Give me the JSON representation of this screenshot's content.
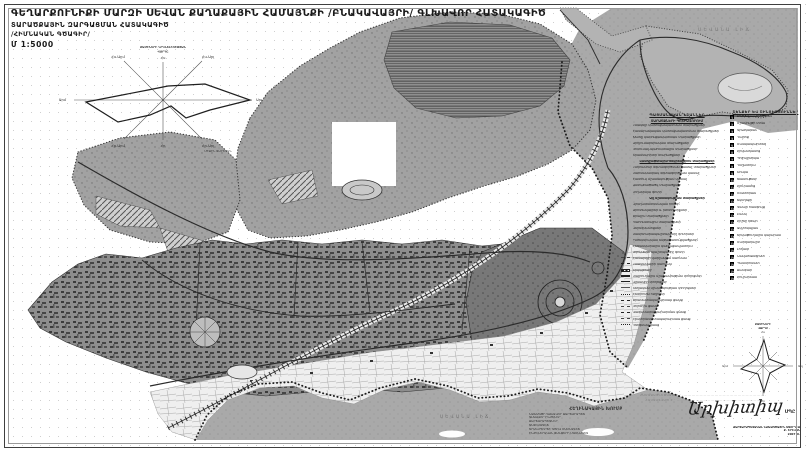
{
  "title": {
    "line1": "ԳԵՂԱՐՔՈՒՆԻՔԻ ՄԱՐԶԻ ՍԵՎԱՆ ՔԱՂԱՔԱՅԻՆ ՀԱՄԱՅՆՔԻ /ԲՆԱԿԱՎԱՅՐԻ/ ԳԼԽԱՎՈՐ ՀԱՏԱԿԱԳԻԾ",
    "line2": "ՏԱՐԱԾՔԱՅԻՆ ԶԱՐԳԱՑՄԱՆ ՀԱՏԱԿԱԳԻԾ",
    "line3": "/ՀԻՄՆԱԿԱՆ ԳԾԱԳԻՐ/",
    "scale": "Մ 1:5000"
  },
  "map_labels": {
    "lake_main": "ՍԵՎԱՆԱ ԼԻՃ",
    "lake_bay": "ՍԵՎԱՆԱ ԼԻՃ"
  },
  "wind_rose_top": {
    "title_line1": "ՔԱՄԻՆԵՐԻ ԿՐԿՆԵԼԻՈՒԹՅԱՆ",
    "title_line2": "ՎԱՐԴԸ",
    "note": "ՄԻՋԻՆ ՏԱՐԵԿԱՆ",
    "dir_n": "Հս",
    "dir_ne": "Հս-Արլ",
    "dir_e": "Արլ",
    "dir_se": "Հր-Արլ",
    "dir_s": "Հր",
    "dir_sw": "Հր-Արմ",
    "dir_w": "Արմ",
    "dir_nw": "Հս-Արմ"
  },
  "wind_rose_bottom": {
    "title": "ՔԱՄԻՆԵՐԻ",
    "title2": "ՎԱՐԴԸ",
    "dir_n": "Հս",
    "dir_s": "Հր",
    "dir_w": "Արմ",
    "dir_e": "Արլ"
  },
  "legend_zones": {
    "header": "ՊԱՅՄԱՆԱԿԱՆ ՆՇԱՆՆԵՐ",
    "subheader": "ՏԱՐԱԾՔՆԵՐԻ ԳՈՏԻԱՎՈՐՈՒՄ",
    "items": [
      {
        "type": "swatch",
        "swatch": "sw-urban",
        "label": "Բնակելի կառուցապատման տարածքներ"
      },
      {
        "type": "swatch",
        "swatch": "sw-cross",
        "label": "Հասարակական կառուցապատման տարածքներ"
      },
      {
        "type": "swatch",
        "swatch": "sw-gray60",
        "label": "Խառը կառուցապատման տարածքներ"
      },
      {
        "type": "swatch",
        "swatch": "sw-gray45",
        "label": "Արդյունաբերական տարածքներ"
      },
      {
        "type": "swatch",
        "swatch": "sw-stripe",
        "label": "Կոմունալ-պահեստային տարածքներ"
      },
      {
        "type": "swatch",
        "swatch": "sw-gray30",
        "label": "Տրանսպորտի տարածքներ"
      },
      {
        "type": "subheader",
        "label": "Լանդշաֆտային-ռեկրեացիոն տարածքներ"
      },
      {
        "type": "swatch",
        "swatch": "sw-dots-dark",
        "label": "Ընդհանուր օգտագործման կանաչ տարածքներ"
      },
      {
        "type": "swatch",
        "swatch": "sw-gray70",
        "label": "Սահմանափակ օգտագործման կանաչ"
      },
      {
        "type": "swatch",
        "swatch": "sw-dots",
        "label": "Հատուկ նշանակության կանաչ"
      },
      {
        "type": "swatch",
        "swatch": "sw-gray80",
        "label": "Անտառածածկ տարածքներ"
      },
      {
        "type": "swatch",
        "swatch": "sw-light-dots",
        "label": "Լողափնյա գոտի"
      },
      {
        "type": "subheader",
        "label": "Այլ նշանակության տարածքներ"
      },
      {
        "type": "swatch",
        "swatch": "sw-white",
        "label": "Գյուղատնտեսական հողեր"
      },
      {
        "type": "swatch",
        "swatch": "sw-dots",
        "label": "Արոտավայրեր և խոտհարքներ"
      },
      {
        "type": "swatch",
        "swatch": "sw-water",
        "label": "Ջրային տարածքներ"
      },
      {
        "type": "swatch",
        "swatch": "sw-light",
        "label": "Պահուստային տարածքներ"
      },
      {
        "type": "swatch",
        "swatch": "sw-cross",
        "label": "Գերեզմանոցներ"
      },
      {
        "type": "swatch",
        "swatch": "sw-hatch",
        "label": "Սանիտարապաշտպանիչ գոտիներ"
      },
      {
        "type": "swatch",
        "swatch": "sw-gray50",
        "label": "Ինժեներական ենթակառուցվածքներ"
      },
      {
        "type": "swatch",
        "swatch": "sw-hatch-light",
        "label": "Հեռանկարային կառուցապատում"
      },
      {
        "type": "swatch",
        "swatch": "sw-stripe",
        "label": "Ափամերձ պաշտպանիչ գոտի"
      },
      {
        "type": "line",
        "swatch": "ln-dashdot",
        "label": "Համայնքի վարչական սահման"
      },
      {
        "type": "line",
        "swatch": "ln-dash",
        "label": "Բնակավայրի սահման"
      },
      {
        "type": "line",
        "swatch": "ln-rail",
        "label": "Երկաթուղի"
      },
      {
        "type": "line",
        "swatch": "ln-thick",
        "label": "Մայրուղային նշանակության փողոցներ"
      },
      {
        "type": "line",
        "swatch": "ln-solid",
        "label": "Գլխավոր փողոցներ"
      },
      {
        "type": "line",
        "swatch": "ln-thin",
        "label": "Տեղական նշանակության փողոցներ"
      },
      {
        "type": "line",
        "swatch": "ln-dotted",
        "label": "Հետիոտն ուղիներ"
      },
      {
        "type": "line",
        "swatch": "ln-dash",
        "label": "Ջրամատակարարման ցանց"
      },
      {
        "type": "line",
        "swatch": "ln-dashdot",
        "label": "Կոյուղու ցանց"
      },
      {
        "type": "line",
        "swatch": "ln-dash",
        "label": "Գազամատակարարման ցանց"
      },
      {
        "type": "line",
        "swatch": "ln-dashdot",
        "label": "Էլեկտրամատակարարման ցանց"
      },
      {
        "type": "line",
        "swatch": "ln-dotted",
        "label": "Ոռոգման ցանց"
      }
    ]
  },
  "legend_objects": {
    "header": "ՇԵՆՔԵՐ ԵՎ ՇԻՆՈՒԹՅՈՒՆՆԵՐ",
    "items": [
      {
        "num": "1",
        "label": "Քաղաքապետարան"
      },
      {
        "num": "2",
        "label": "Մշակույթի տուն"
      },
      {
        "num": "3",
        "label": "Գրադարան"
      },
      {
        "num": "4",
        "label": "Դպրոց"
      },
      {
        "num": "5",
        "label": "Մանկապարտեզ"
      },
      {
        "num": "6",
        "label": "Հիվանդանոց"
      },
      {
        "num": "7",
        "label": "Պոլիկլինիկա"
      },
      {
        "num": "8",
        "label": "Դեղատուն"
      },
      {
        "num": "9",
        "label": "Շուկա"
      },
      {
        "num": "10",
        "label": "Խանութներ"
      },
      {
        "num": "11",
        "label": "Հյուրանոց"
      },
      {
        "num": "12",
        "label": "Ռեստորան"
      },
      {
        "num": "13",
        "label": "Եկեղեցի"
      },
      {
        "num": "14",
        "label": "Կապի հանգույց"
      },
      {
        "num": "15",
        "label": "Բանկ"
      },
      {
        "num": "16",
        "label": "Հրշեջ դեպո"
      },
      {
        "num": "17",
        "label": "Ավտոկայան"
      },
      {
        "num": "18",
        "label": "Երկաթուղային կայարան"
      },
      {
        "num": "19",
        "label": "Մարզադաշտ"
      },
      {
        "num": "20",
        "label": "Լողափ"
      },
      {
        "num": "21",
        "label": "Նավահանգիստ"
      },
      {
        "num": "22",
        "label": "Պանսիոնատ"
      },
      {
        "num": "23",
        "label": "Ճամբար"
      },
      {
        "num": "24",
        "label": "Հուշարձան"
      }
    ]
  },
  "credits": {
    "heading": "ՀԵՂԻՆԱԿԱՅԻՆ ԽՈՒՄԲ",
    "lines": [
      "ՆԱԽԱԳԾԻ ԳԼԽԱՎՈՐ ՃԱՐՏԱՐԱՊԵՏ",
      "ԳԼԽԱՎՈՐ ԻՆԺԵՆԵՐ",
      "ՃԱՐՏԱՐԱՊԵՏՆԵՐ",
      "ՏՆՏԵՍԱԳԵՏ",
      "ՏՐԱՆՍՊՈՐՏԻ ԳԾՈՎ ՄԱՍՆԱԳԵՏ",
      "ԻՆԺԵՆԵՐԱԿԱՆ ՑԱՆՑԵՐԻ ՄԱՍՆԱԳԵՏ"
    ]
  },
  "approval": {
    "line1": "ՀԱՄԱՁԱՅՆԵՑՎԱԾ Է ՝ ..............................................................",
    "line2": "ՀԱՍՏԱՏՎԱԾ Է ՝ .............................................................."
  },
  "signature": {
    "name": "Արխիտիպ",
    "suffix": "ՍՊԸ",
    "contact_lines": [
      "ՃԱՐՏԱՐԱՊԵՏԱԿԱՆ ՆԱԽԱԳԾԱՅԻՆ ՍՏՈՒԴԻԱ",
      "Ք. ԵՐԵՎԱՆ",
      "2007 Թ."
    ]
  },
  "colors": {
    "water": "#a9a9a9",
    "terrain": "#a2a2a2",
    "urban_base": "#8d8d8d",
    "urban_block": "#3c3c3c",
    "park": "#777777",
    "peninsula": "#b3b3b3",
    "road": "#2b2b2b",
    "frame": "#3f3f3f"
  }
}
